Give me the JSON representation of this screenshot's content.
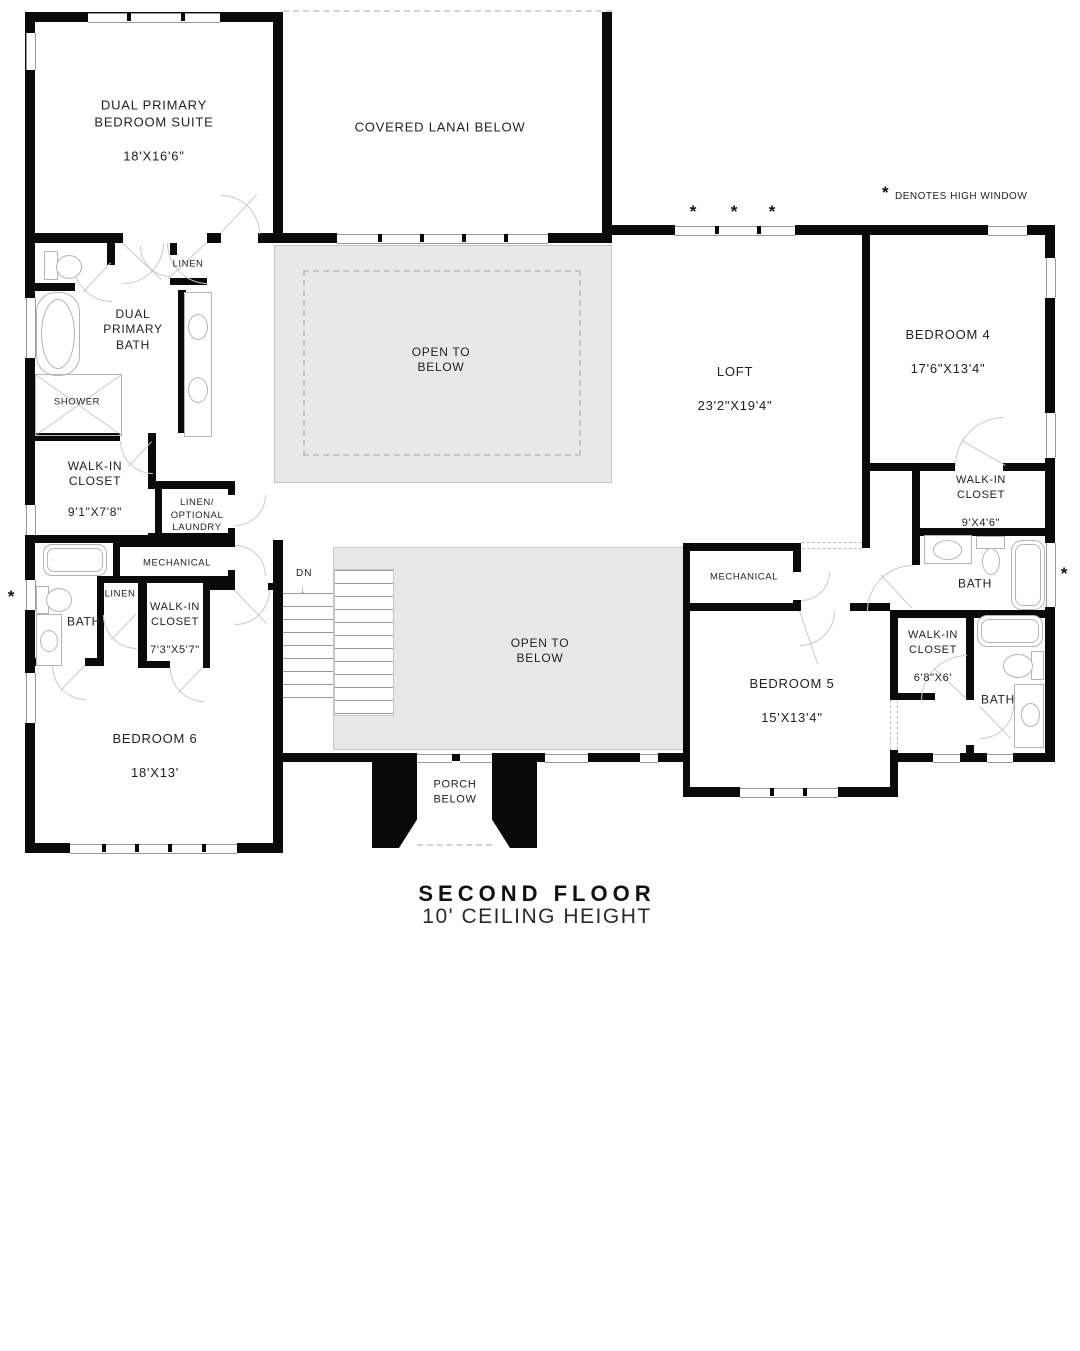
{
  "title": {
    "main": "SECOND FLOOR",
    "subtitle": "10' CEILING HEIGHT"
  },
  "legend": {
    "symbol": "*",
    "text": "DENOTES HIGH WINDOW"
  },
  "high_window_symbol": "*",
  "stairs": {
    "label": "DN",
    "arrow": "↓"
  },
  "colors": {
    "wall": "#0a0a0a",
    "open_area_fill": "#e8e8e8",
    "fixture_line": "#b5b5b5",
    "text": "#1f1f1f"
  },
  "rooms": [
    {
      "id": "dual-primary-suite",
      "name": "DUAL PRIMARY\nBEDROOM SUITE",
      "dims": "18'X16'6\""
    },
    {
      "id": "covered-lanai",
      "name": "COVERED LANAI BELOW",
      "dims": ""
    },
    {
      "id": "open-to-below-upper",
      "name": "OPEN TO\nBELOW",
      "dims": ""
    },
    {
      "id": "loft",
      "name": "LOFT",
      "dims": "23'2\"X19'4\""
    },
    {
      "id": "bedroom-4",
      "name": "BEDROOM 4",
      "dims": "17'6\"X13'4\""
    },
    {
      "id": "dual-primary-bath",
      "name": "DUAL\nPRIMARY\nBATH",
      "dims": ""
    },
    {
      "id": "shower",
      "name": "SHOWER",
      "dims": ""
    },
    {
      "id": "linen-primary",
      "name": "LINEN",
      "dims": ""
    },
    {
      "id": "walk-in-closet-primary",
      "name": "WALK-IN\nCLOSET",
      "dims": "9'1\"X7'8\""
    },
    {
      "id": "linen-optional-laundry",
      "name": "LINEN/\nOPTIONAL\nLAUNDRY",
      "dims": ""
    },
    {
      "id": "mechanical-left",
      "name": "MECHANICAL",
      "dims": ""
    },
    {
      "id": "linen-hall",
      "name": "LINEN",
      "dims": ""
    },
    {
      "id": "bath-left",
      "name": "BATH",
      "dims": ""
    },
    {
      "id": "walk-in-closet-bedroom6",
      "name": "WALK-IN\nCLOSET",
      "dims": "7'3\"X5'7\""
    },
    {
      "id": "bedroom-6",
      "name": "BEDROOM 6",
      "dims": "18'X13'"
    },
    {
      "id": "open-to-below-lower",
      "name": "OPEN TO\nBELOW",
      "dims": ""
    },
    {
      "id": "porch-below",
      "name": "PORCH\nBELOW",
      "dims": ""
    },
    {
      "id": "mechanical-right",
      "name": "MECHANICAL",
      "dims": ""
    },
    {
      "id": "bedroom-5",
      "name": "BEDROOM 5",
      "dims": "15'X13'4\""
    },
    {
      "id": "walk-in-closet-bedroom4",
      "name": "WALK-IN\nCLOSET",
      "dims": "9'X4'6\""
    },
    {
      "id": "bath-upper-right",
      "name": "BATH",
      "dims": ""
    },
    {
      "id": "walk-in-closet-bedroom5",
      "name": "WALK-IN\nCLOSET",
      "dims": "6'8\"X6'"
    },
    {
      "id": "bath-lower-right",
      "name": "BATH",
      "dims": ""
    }
  ]
}
